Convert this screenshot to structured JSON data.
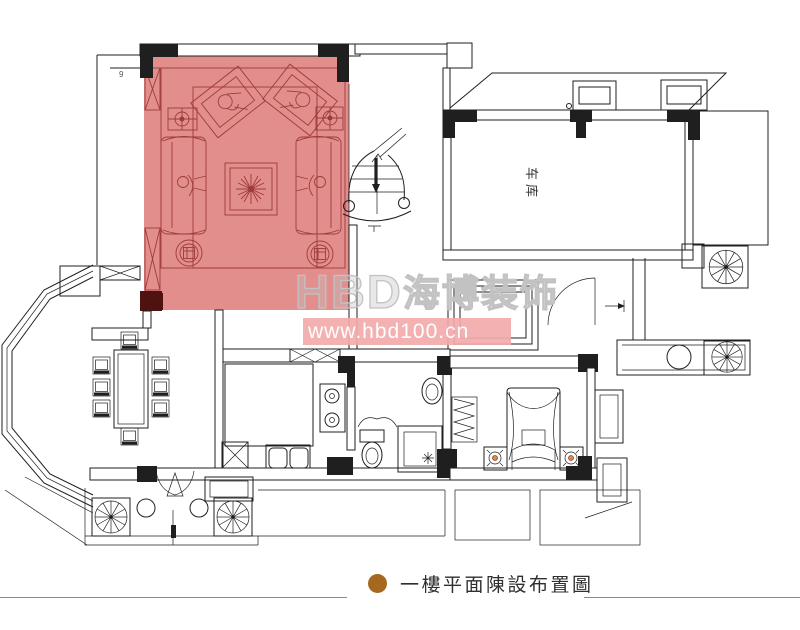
{
  "plan": {
    "garage_label": "车库",
    "dim_mark": "9"
  },
  "watermark": {
    "latin": "HBD",
    "cjk": "海博装饰",
    "url": "www.hbd100.cn"
  },
  "caption": {
    "text": "一樓平面陳設布置圖"
  },
  "colors": {
    "line": "#1f1f1f",
    "highlight": "#e28e8d",
    "furn": "#9e3b3b",
    "darkcol": "#4f1210",
    "lamp": "#d09040",
    "wmtext": "#c2c2c2",
    "wmbar": "#f2abab",
    "bullet": "#a5681e",
    "captext": "#2f2f2f"
  }
}
